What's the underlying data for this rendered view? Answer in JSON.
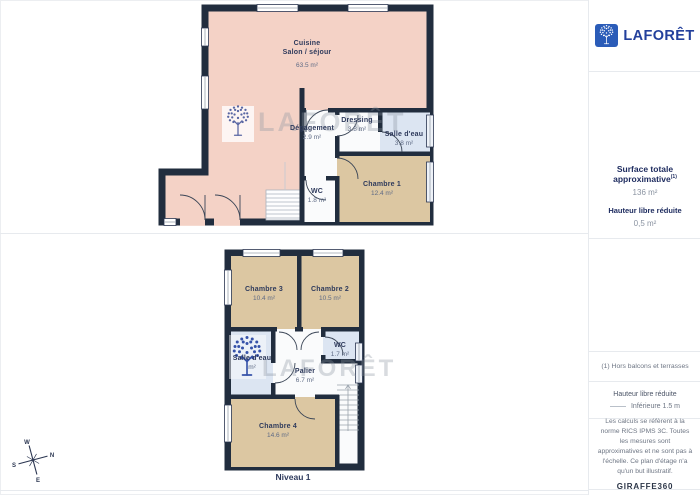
{
  "colors": {
    "wall": "#212d3e",
    "room_pink": "#f4d2c6",
    "room_tan": "#dcc7a2",
    "room_blue": "#dce5f2",
    "room_white": "#fafbfc",
    "brand_blue": "#2b5cb8",
    "brand_navy": "#23409c"
  },
  "watermark": {
    "text": "LAFORÊT"
  },
  "plan_top": {
    "rooms": [
      {
        "name": "Cuisine",
        "name2": "Salon / séjour",
        "area": "63.5 m²"
      },
      {
        "name": "Dégagement",
        "area": "2.9 m²"
      },
      {
        "name": "Dressing",
        "area": "3.8 m²"
      },
      {
        "name": "Salle d'eau",
        "area": "3.8 m²"
      },
      {
        "name": "Chambre 1",
        "area": "12.4 m²"
      },
      {
        "name": "WC",
        "area": "1.8 m²"
      }
    ]
  },
  "plan_bottom": {
    "level_label": "Niveau 1",
    "rooms": [
      {
        "name": "Chambre 3",
        "area": "10.4 m²"
      },
      {
        "name": "Chambre 2",
        "area": "10.5 m²"
      },
      {
        "name": "WC",
        "area": "1.7 m²"
      },
      {
        "name": "Salle d'eau",
        "area": "m²"
      },
      {
        "name": "Palier",
        "area": "6.7 m²"
      },
      {
        "name": "Chambre 4",
        "area": "14.6 m²"
      }
    ]
  },
  "compass": {
    "n": "N",
    "e": "E",
    "s": "S",
    "w": "W"
  },
  "sidebar": {
    "logo_text": "LAFORÊT",
    "surface_title": "Surface totale approximative",
    "surface_sup": "(1)",
    "surface_value": "136 m²",
    "reduced_height_title": "Hauteur libre réduite",
    "reduced_height_value": "0,5 m²",
    "footnote": "(1) Hors balcons et terrasses",
    "legend_title": "Hauteur libre réduite",
    "legend_item": "Inférieure 1.5 m",
    "disclaimer": "Les calculs se réfèrent à la norme RICS IPMS 3C. Toutes les mesures sont approximatives et ne sont pas à l'échelle. Ce plan d'étage n'a qu'un but illustratif.",
    "brand_footer_1": "GIRAFFE",
    "brand_footer_2": "360"
  }
}
